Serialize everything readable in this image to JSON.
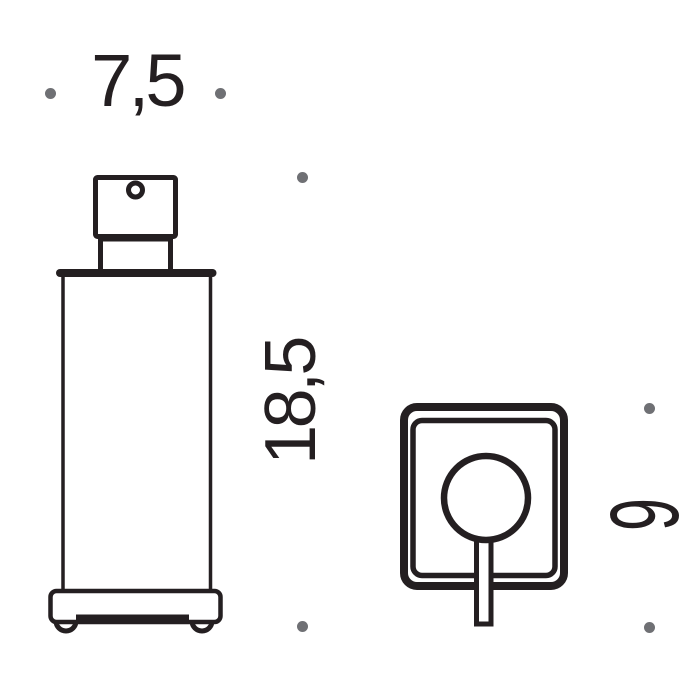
{
  "colors": {
    "background": "#ffffff",
    "line": "#241f21",
    "text": "#241f21",
    "dot": "#6f7074"
  },
  "labels": {
    "width": "7,5",
    "height": "18,5",
    "depth": "9"
  }
}
